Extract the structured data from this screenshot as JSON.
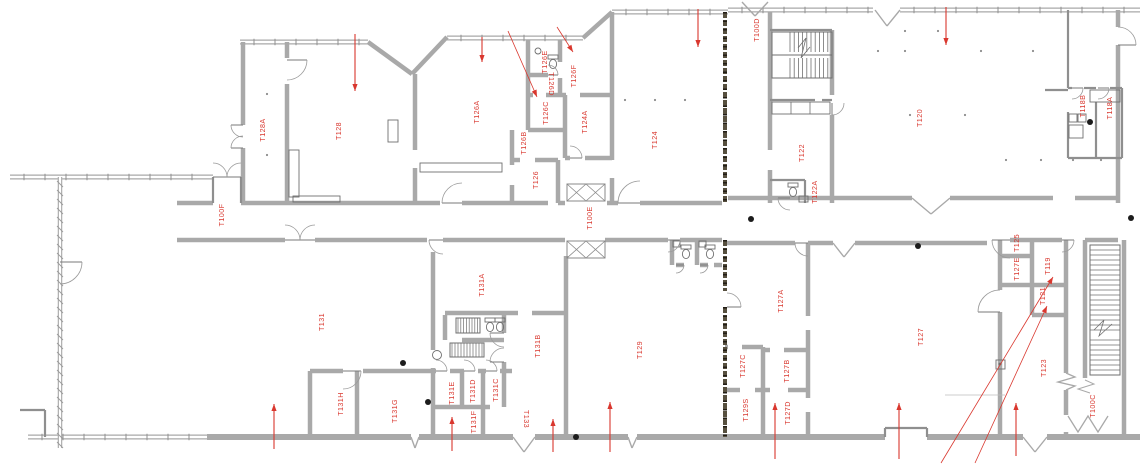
{
  "drawing": {
    "type": "architectural-floor-plan",
    "colors": {
      "label_red": "#d9372e",
      "wall_gray": "#a9a9a9",
      "partition_gray": "#8f8f8f",
      "fixture_gray": "#6f6f6f",
      "demising_dark": "#57503f",
      "background": "#ffffff"
    },
    "rooms": [
      {
        "id": "T128A",
        "x": 263,
        "y": 130,
        "rot": -90
      },
      {
        "id": "T128",
        "x": 339,
        "y": 131,
        "rot": -90
      },
      {
        "id": "T100F",
        "x": 222,
        "y": 215,
        "rot": -90
      },
      {
        "id": "T126A",
        "x": 477,
        "y": 112,
        "rot": -90
      },
      {
        "id": "T126E",
        "x": 545,
        "y": 62,
        "rot": -90
      },
      {
        "id": "T126D",
        "x": 551,
        "y": 84,
        "rot": 90
      },
      {
        "id": "T126F",
        "x": 574,
        "y": 76,
        "rot": -90
      },
      {
        "id": "T126C",
        "x": 546,
        "y": 113,
        "rot": -90
      },
      {
        "id": "T126B",
        "x": 524,
        "y": 143,
        "rot": -90
      },
      {
        "id": "T124A",
        "x": 585,
        "y": 122,
        "rot": -90
      },
      {
        "id": "T126",
        "x": 536,
        "y": 180,
        "rot": -90
      },
      {
        "id": "T124",
        "x": 655,
        "y": 140,
        "rot": -90
      },
      {
        "id": "T100E",
        "x": 590,
        "y": 218,
        "rot": -90
      },
      {
        "id": "T100D",
        "x": 757,
        "y": 30,
        "rot": -90
      },
      {
        "id": "T122",
        "x": 802,
        "y": 153,
        "rot": -90
      },
      {
        "id": "T122A",
        "x": 815,
        "y": 192,
        "rot": -90
      },
      {
        "id": "T120",
        "x": 920,
        "y": 118,
        "rot": -90
      },
      {
        "id": "T118B",
        "x": 1083,
        "y": 106,
        "rot": -90
      },
      {
        "id": "T118A",
        "x": 1110,
        "y": 108,
        "rot": -90
      },
      {
        "id": "T131",
        "x": 322,
        "y": 322,
        "rot": -90
      },
      {
        "id": "T131A",
        "x": 482,
        "y": 285,
        "rot": -90
      },
      {
        "id": "T131B",
        "x": 538,
        "y": 346,
        "rot": -90
      },
      {
        "id": "T131H",
        "x": 341,
        "y": 404,
        "rot": -90
      },
      {
        "id": "T131G",
        "x": 395,
        "y": 411,
        "rot": -90
      },
      {
        "id": "T131E",
        "x": 452,
        "y": 393,
        "rot": -90
      },
      {
        "id": "T131D",
        "x": 473,
        "y": 391,
        "rot": -90
      },
      {
        "id": "T131C",
        "x": 496,
        "y": 390,
        "rot": -90
      },
      {
        "id": "T131F",
        "x": 474,
        "y": 422,
        "rot": -90
      },
      {
        "id": "T133",
        "x": 526,
        "y": 419,
        "rot": 90
      },
      {
        "id": "T129",
        "x": 640,
        "y": 350,
        "rot": -90
      },
      {
        "id": "T129S",
        "x": 746,
        "y": 410,
        "rot": -90
      },
      {
        "id": "T127C",
        "x": 743,
        "y": 366,
        "rot": -90
      },
      {
        "id": "T127A",
        "x": 781,
        "y": 301,
        "rot": -90
      },
      {
        "id": "T127B",
        "x": 787,
        "y": 371,
        "rot": -90
      },
      {
        "id": "T127D",
        "x": 788,
        "y": 413,
        "rot": -90
      },
      {
        "id": "T127",
        "x": 921,
        "y": 337,
        "rot": -90
      },
      {
        "id": "T125",
        "x": 1017,
        "y": 243,
        "rot": -90
      },
      {
        "id": "T127E",
        "x": 1017,
        "y": 269,
        "rot": -90
      },
      {
        "id": "T119",
        "x": 1048,
        "y": 266,
        "rot": -90
      },
      {
        "id": "T121",
        "x": 1043,
        "y": 296,
        "rot": -90
      },
      {
        "id": "T123",
        "x": 1044,
        "y": 368,
        "rot": -90
      },
      {
        "id": "T100C",
        "x": 1093,
        "y": 406,
        "rot": -90
      }
    ],
    "egress_arrows": [
      {
        "x1": 355,
        "y1": 34,
        "x2": 355,
        "y2": 91
      },
      {
        "x1": 482,
        "y1": 37,
        "x2": 482,
        "y2": 62
      },
      {
        "x1": 698,
        "y1": 9,
        "x2": 698,
        "y2": 47
      },
      {
        "x1": 946,
        "y1": 7,
        "x2": 946,
        "y2": 45
      },
      {
        "x1": 274,
        "y1": 449,
        "x2": 274,
        "y2": 404
      },
      {
        "x1": 452,
        "y1": 451,
        "x2": 452,
        "y2": 417
      },
      {
        "x1": 553,
        "y1": 452,
        "x2": 553,
        "y2": 419
      },
      {
        "x1": 610,
        "y1": 452,
        "x2": 610,
        "y2": 402
      },
      {
        "x1": 775,
        "y1": 459,
        "x2": 775,
        "y2": 403
      },
      {
        "x1": 899,
        "y1": 459,
        "x2": 899,
        "y2": 403
      },
      {
        "x1": 1016,
        "y1": 456,
        "x2": 1016,
        "y2": 403
      }
    ],
    "leader_arrows": [
      {
        "x1": 508,
        "y1": 31,
        "x2": 537,
        "y2": 97
      },
      {
        "x1": 557,
        "y1": 27,
        "x2": 573,
        "y2": 52
      },
      {
        "x1": 941,
        "y1": 463,
        "x2": 1053,
        "y2": 277
      },
      {
        "x1": 975,
        "y1": 463,
        "x2": 1047,
        "y2": 306
      }
    ],
    "black_fixture_dots": [
      {
        "x": 751,
        "y": 219
      },
      {
        "x": 918,
        "y": 246
      },
      {
        "x": 428,
        "y": 402
      },
      {
        "x": 1131,
        "y": 218
      },
      {
        "x": 403,
        "y": 363
      },
      {
        "x": 1090,
        "y": 122
      },
      {
        "x": 576,
        "y": 437
      }
    ],
    "ceiling_dots": [
      {
        "x": 905,
        "y": 31
      },
      {
        "x": 938,
        "y": 31
      },
      {
        "x": 878,
        "y": 51
      },
      {
        "x": 905,
        "y": 51
      },
      {
        "x": 981,
        "y": 51
      },
      {
        "x": 1033,
        "y": 51
      },
      {
        "x": 910,
        "y": 115
      },
      {
        "x": 965,
        "y": 115
      },
      {
        "x": 1006,
        "y": 160
      },
      {
        "x": 1041,
        "y": 160
      },
      {
        "x": 1073,
        "y": 160
      },
      {
        "x": 1101,
        "y": 160
      },
      {
        "x": 267,
        "y": 94
      },
      {
        "x": 267,
        "y": 155
      },
      {
        "x": 625,
        "y": 100
      },
      {
        "x": 655,
        "y": 100
      },
      {
        "x": 685,
        "y": 100
      }
    ]
  }
}
